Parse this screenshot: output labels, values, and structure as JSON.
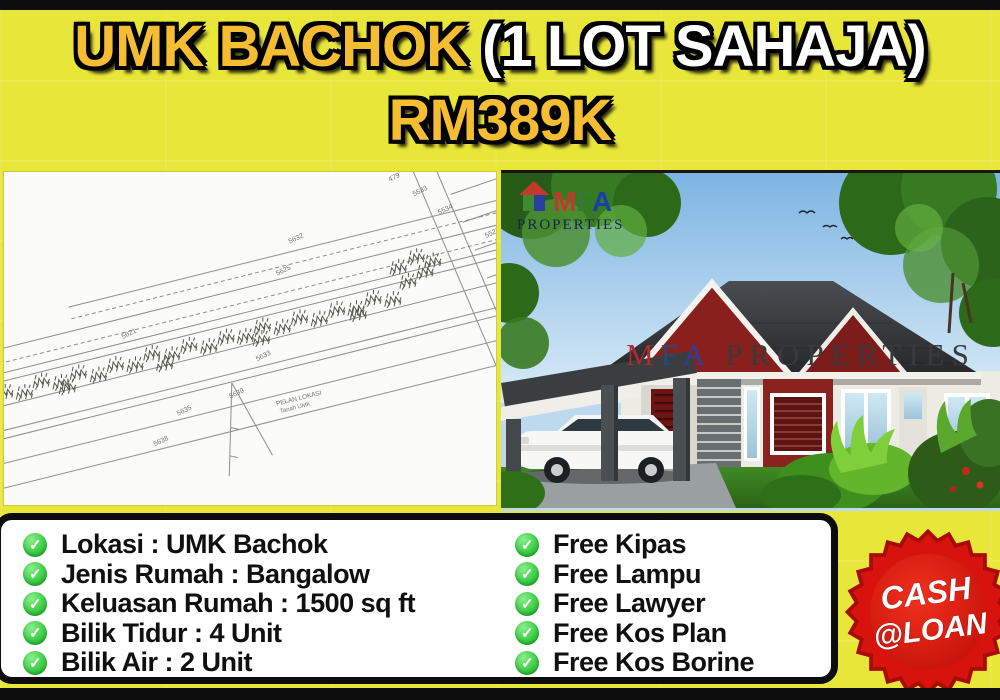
{
  "header": {
    "location": "UMK BACHOK ",
    "lot": "(1 LOT SAHAJA)",
    "price": "RM389K"
  },
  "plan": {
    "labels": [
      "5621",
      "5625",
      "5632",
      "5633",
      "5639",
      "5635",
      "5638",
      "479",
      "5533",
      "5534",
      "5527",
      "5529",
      "5532",
      "5538"
    ],
    "caption1": "PELAN LOKASI",
    "caption2": "Tanah UMK"
  },
  "photo": {
    "logo": {
      "m": "M",
      "f": "F",
      "a": "A",
      "sub": "PROPERTIES"
    },
    "watermark": {
      "m": "M",
      "f": "F",
      "a": "A",
      "rest": " PROPERTIES"
    }
  },
  "details": {
    "left": [
      "Lokasi : UMK Bachok",
      "Jenis Rumah : Bangalow",
      "Keluasan Rumah : 1500 sq ft",
      "Bilik Tidur : 4 Unit",
      "Bilik Air : 2 Unit"
    ],
    "right": [
      "Free Kipas",
      "Free Lampu",
      "Free Lawyer",
      "Free Kos Plan",
      "Free Kos Borine"
    ]
  },
  "badge": {
    "line1": "CASH",
    "line2": "@LOAN"
  },
  "icons": {
    "check": "✓"
  },
  "colors": {
    "background_yellow": "#e9e63a",
    "title_gold": "#f5bd31",
    "badge_red": "#dd1510",
    "check_green": "#3ecf48",
    "gable_maroon": "#8a201e"
  }
}
